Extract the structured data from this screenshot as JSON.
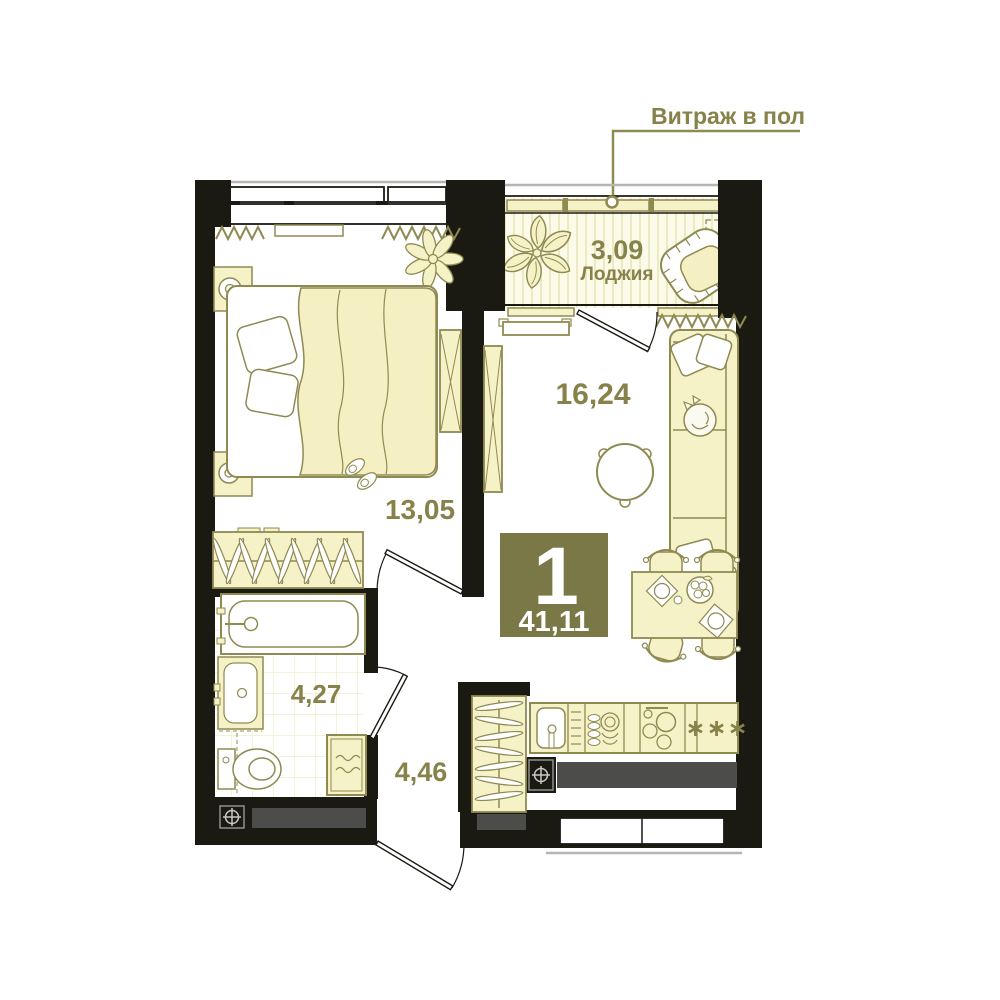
{
  "annotation": {
    "label": "Витраж в пол"
  },
  "badge": {
    "rooms": "1",
    "total_area": "41,11"
  },
  "rooms": {
    "loggia": {
      "area": "3,09",
      "name": "Лоджия"
    },
    "living": {
      "area": "16,24"
    },
    "bedroom": {
      "area": "13,05"
    },
    "bathroom": {
      "area": "4,27"
    },
    "hallway": {
      "area": "4,46"
    }
  },
  "kitchen": {
    "freezer_mark": "∗∗∗"
  },
  "colors": {
    "wall": "#1b1a12",
    "outline": "#8f8a52",
    "label_text": "#87824a",
    "furniture_fill": "#f6f2c7",
    "badge_bg": "#7b7848",
    "badge_text": "#ffffff",
    "apron_gray": "#4c4c4a"
  }
}
